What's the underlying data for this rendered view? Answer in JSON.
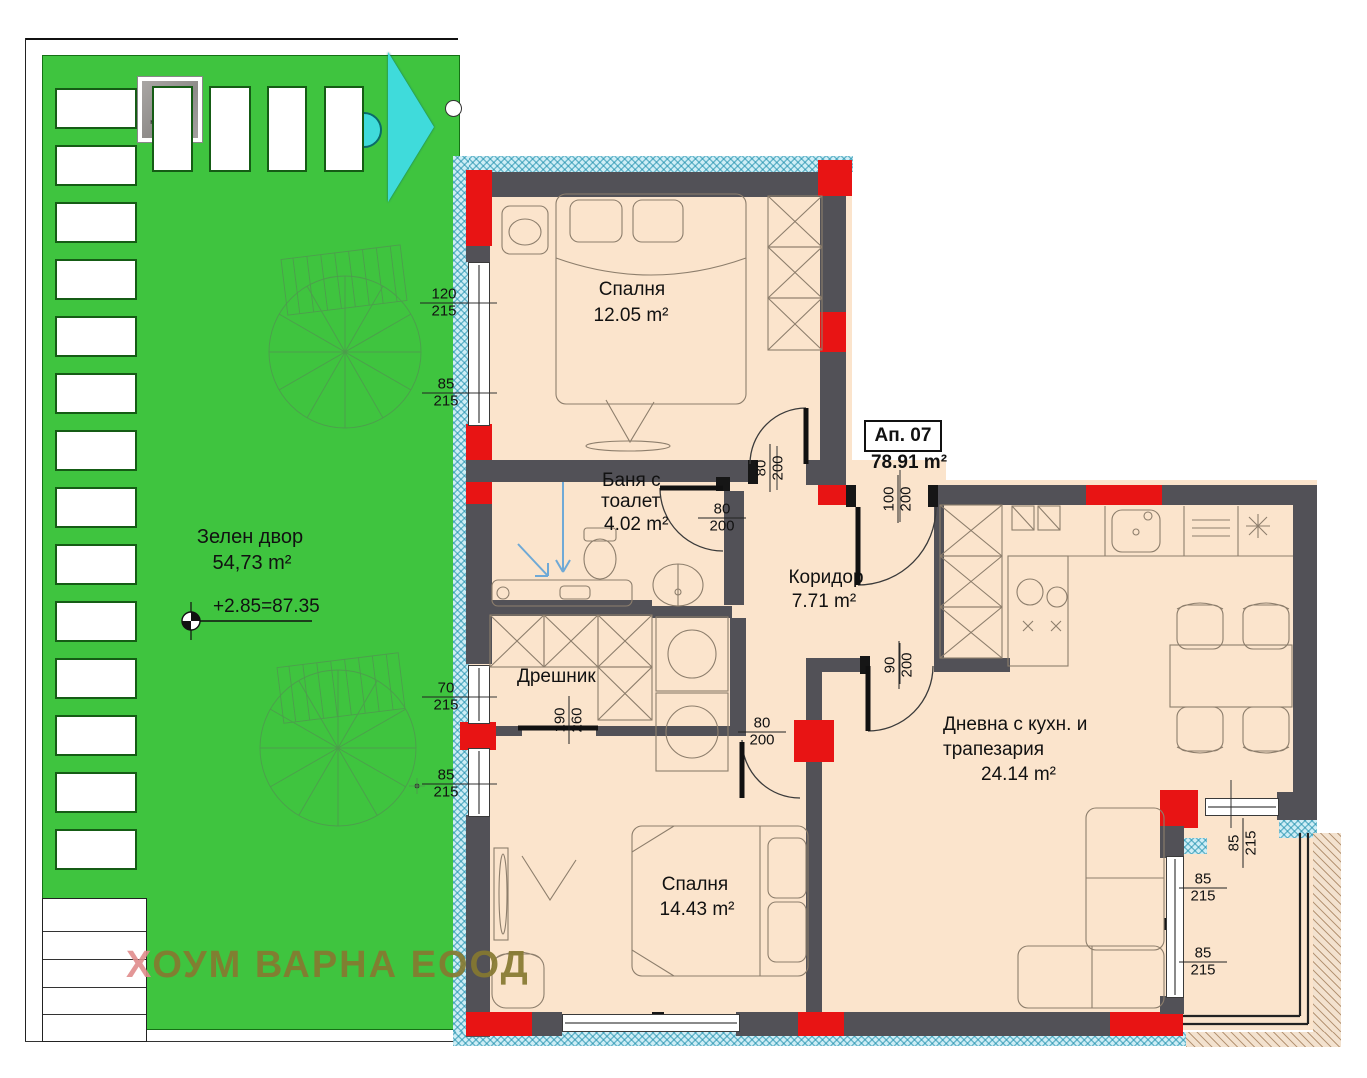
{
  "yard": {
    "name": "Зелен двор",
    "area": "54,73 m²",
    "elevation": "+2.85=87.35"
  },
  "apartment": {
    "label": "Ап. 07",
    "area": "78.91 m²"
  },
  "rooms": [
    {
      "id": "bedroom-1",
      "line1": "Спалня",
      "line2": "",
      "area": "12.05 m²"
    },
    {
      "id": "bathroom",
      "line1": "Баня с",
      "line2": "тоалет",
      "area": "4.02 m²"
    },
    {
      "id": "corridor",
      "line1": "Коридор",
      "line2": "",
      "area": "7.71 m²"
    },
    {
      "id": "closet",
      "line1": "Дрешник",
      "line2": "",
      "area": ""
    },
    {
      "id": "bedroom-2",
      "line1": "Спалня",
      "line2": "",
      "area": "14.43 m²"
    },
    {
      "id": "living",
      "line1": "Дневна с кухн. и",
      "line2": "трапезария",
      "area": "24.14 m²"
    }
  ],
  "dimensions": [
    {
      "num": "120",
      "den": "215"
    },
    {
      "num": "85",
      "den": "215"
    },
    {
      "num": "70",
      "den": "215"
    },
    {
      "num": "85",
      "den": "215"
    },
    {
      "num": "80",
      "den": "200"
    },
    {
      "num": "80",
      "den": "200"
    },
    {
      "num": "100",
      "den": "200"
    },
    {
      "num": "90",
      "den": "200"
    },
    {
      "num": "80",
      "den": "200"
    },
    {
      "num": "190",
      "den": "260"
    },
    {
      "num": "85",
      "den": "215"
    },
    {
      "num": "85",
      "den": "215"
    },
    {
      "num": "85",
      "den": "215"
    }
  ],
  "watermark": {
    "prefix": "Х",
    "rest": "ОУМ ВАРНА ЕООД"
  },
  "logo": {
    "text": "HOMEVARNA"
  },
  "colors": {
    "yard_green": "#3fc43f",
    "wall_gray": "#525157",
    "accent_red": "#e81414",
    "floor_peach": "#fbe4cc",
    "insulation_cyan": "#cfeef6",
    "arrow_teal": "#3fdbdb"
  }
}
